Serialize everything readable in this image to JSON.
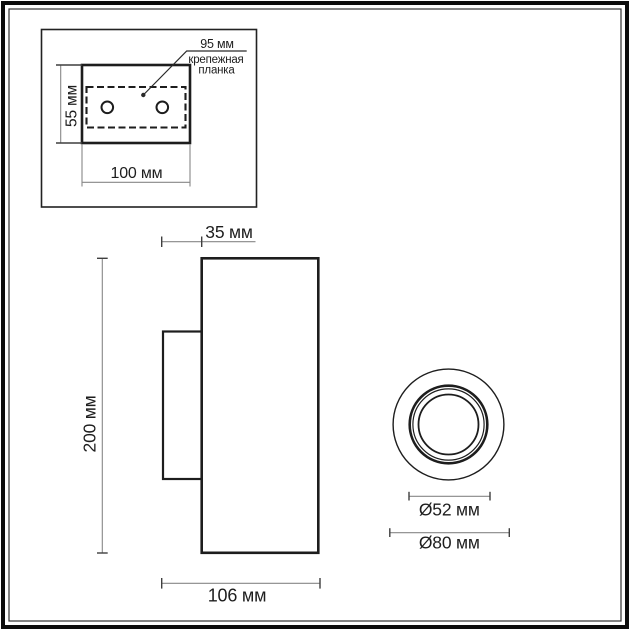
{
  "page": {
    "type": "technical-dimension-drawing",
    "background": "#ffffff",
    "frame_color": "#0c0c0c"
  },
  "colors": {
    "outline": "#1d1d1d",
    "dimension_line": "#878787",
    "tick": "#3f3f3f",
    "text": "#1e1e1e"
  },
  "detail_view": {
    "dim_bar_width_label": "95 мм",
    "callout_line1": "крепежная",
    "callout_line2": "планка",
    "dim_height_label": "55 мм",
    "dim_width_label": "100 мм"
  },
  "side_view": {
    "dim_offset_label": "35 мм",
    "dim_height_label": "200 мм",
    "dim_depth_label": "106 мм"
  },
  "front_view": {
    "dim_inner_diameter_label": "Ø52 мм",
    "dim_outer_diameter_label": "Ø80 мм"
  }
}
